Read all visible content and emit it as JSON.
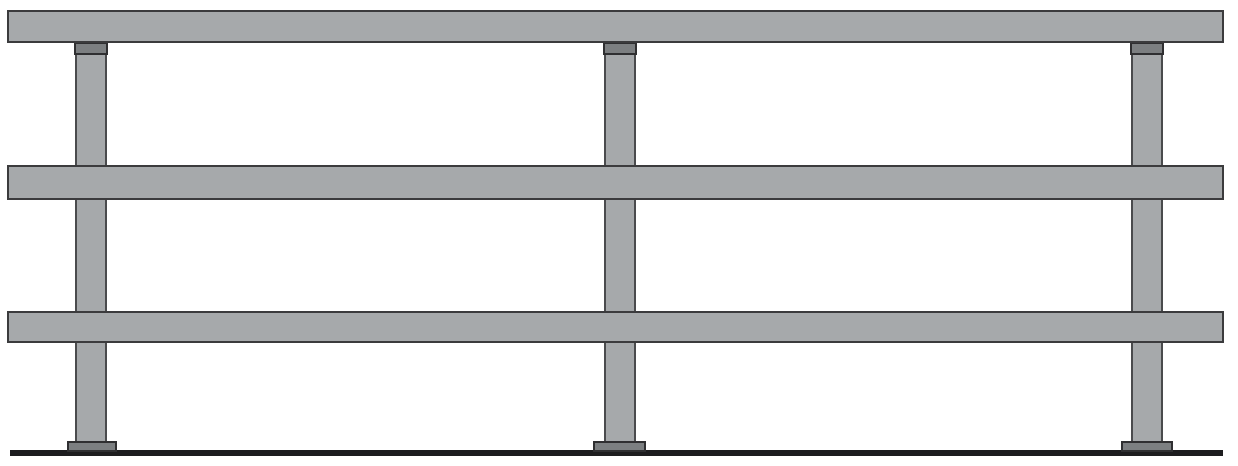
{
  "drawing": {
    "name": "guardrail-elevation-drawing",
    "canvas": {
      "width": 1238,
      "height": 466,
      "background": "#ffffff"
    },
    "colors": {
      "member_fill": "#a6a9ab",
      "rail_outline": "#3b3b3d",
      "post_outline": "#4a4b4d",
      "fitting_fill": "#7c7f81",
      "fitting_outline": "#2f2f31",
      "ground": "#1d1d1f"
    },
    "rails": [
      {
        "name": "top-rail",
        "x": 7,
        "y": 10,
        "w": 1217,
        "h": 33
      },
      {
        "name": "middle-rail",
        "x": 7,
        "y": 165,
        "w": 1217,
        "h": 35
      },
      {
        "name": "bottom-rail",
        "x": 7,
        "y": 311,
        "w": 1217,
        "h": 32
      }
    ],
    "posts": [
      {
        "name": "post-left",
        "x": 75,
        "y": 43,
        "w": 32,
        "h": 402
      },
      {
        "name": "post-middle",
        "x": 604,
        "y": 43,
        "w": 32,
        "h": 402
      },
      {
        "name": "post-right",
        "x": 1131,
        "y": 43,
        "w": 32,
        "h": 402
      }
    ],
    "brackets": [
      {
        "name": "top-rail-bracket-left",
        "x": 74,
        "y": 42,
        "w": 34,
        "h": 13
      },
      {
        "name": "top-rail-bracket-middle",
        "x": 603,
        "y": 42,
        "w": 34,
        "h": 13
      },
      {
        "name": "top-rail-bracket-right",
        "x": 1130,
        "y": 42,
        "w": 34,
        "h": 13
      }
    ],
    "base_plates": [
      {
        "name": "base-plate-left",
        "x": 67,
        "y": 441,
        "w": 50,
        "h": 11
      },
      {
        "name": "base-plate-middle",
        "x": 593,
        "y": 441,
        "w": 53,
        "h": 11
      },
      {
        "name": "base-plate-right",
        "x": 1121,
        "y": 441,
        "w": 52,
        "h": 11
      }
    ],
    "ground_line": {
      "name": "ground-line",
      "x": 10,
      "y": 450,
      "w": 1213,
      "h": 6
    }
  }
}
